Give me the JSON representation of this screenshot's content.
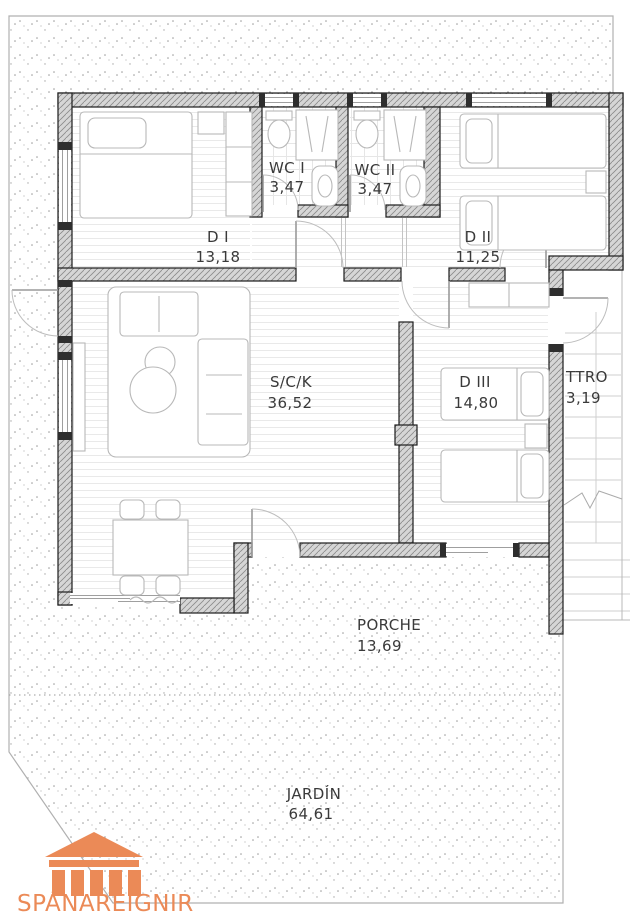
{
  "plan": {
    "type": "floor-plan",
    "rooms": [
      {
        "id": "wc1",
        "name": "WC I",
        "area": "3,47"
      },
      {
        "id": "wc2",
        "name": "WC II",
        "area": "3,47"
      },
      {
        "id": "d1",
        "name": "D I",
        "area": "13,18"
      },
      {
        "id": "d2",
        "name": "D II",
        "area": "11,25"
      },
      {
        "id": "sck",
        "name": "S/C/K",
        "area": "36,52"
      },
      {
        "id": "d3",
        "name": "D III",
        "area": "14,80"
      },
      {
        "id": "ttro",
        "name": "TTRO",
        "area": "3,19"
      },
      {
        "id": "porche",
        "name": "PORCHE",
        "area": "13,69"
      },
      {
        "id": "jardin",
        "name": "JARDÍN",
        "area": "64,61"
      }
    ],
    "branding": {
      "logo_text": "SPÁNAREIGNIR",
      "logo_icon": "temple-icon",
      "logo_color": "#EB8A57"
    },
    "colors": {
      "wall_fill": "#d6d6d6",
      "line_gray": "#b0b0b0",
      "text_gray": "#3a3a3a"
    }
  }
}
